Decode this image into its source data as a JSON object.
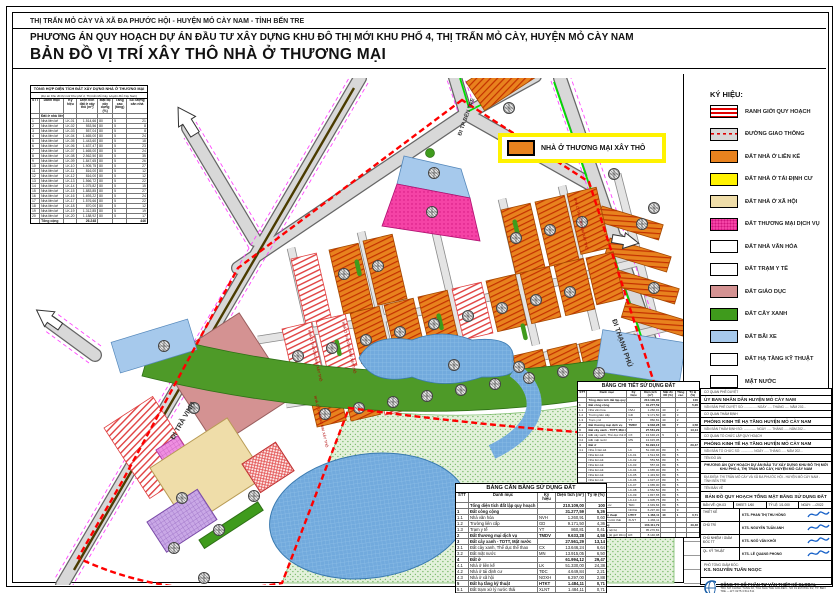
{
  "header": {
    "line1": "THỊ TRẤN MỎ CÀY VÀ XÃ ĐA PHƯỚC HỘI - HUYỆN MỎ CÀY NAM - TỈNH BẾN TRE",
    "line2": "PHƯƠNG ÁN QUY HOẠCH DỰ ÁN ĐẦU TƯ XÂY DỰNG KHU ĐÔ THỊ MỚI KHU PHỐ 4, THỊ TRẤN MỎ CÀY, HUYỆN MỎ CÀY NAM",
    "title": "BẢN ĐỒ VỊ TRÍ XÂY THÔ NHÀ Ở THƯƠNG MẠI"
  },
  "note": {
    "label": "NHÀ Ở THƯƠNG MẠI XÂY THÔ"
  },
  "legend": {
    "title": "KÝ HIỆU:",
    "items": [
      {
        "key": "boundary",
        "label": "RANH GIỚI QUY HOẠCH"
      },
      {
        "key": "road",
        "label": "ĐƯỜNG GIAO THÔNG"
      },
      {
        "key": "lienke",
        "label": "ĐẤT NHÀ Ở LIÊN KẾ"
      },
      {
        "key": "tdc",
        "label": "ĐẤT NHÀ Ở TÁI ĐỊNH CƯ"
      },
      {
        "key": "xahoi",
        "label": "ĐẤT NHÀ Ở XÃ HỘI"
      },
      {
        "key": "tmdv",
        "label": "ĐẤT THƯƠNG MẠI DỊCH VỤ"
      },
      {
        "key": "vanhoa",
        "label": "ĐẤT NHÀ VĂN HÓA"
      },
      {
        "key": "tramyte",
        "label": "ĐẤT TRẠM Y TẾ"
      },
      {
        "key": "giaoduc",
        "label": "ĐẤT GIÁO DỤC"
      },
      {
        "key": "cayxanh",
        "label": "ĐẤT CÂY XANH"
      },
      {
        "key": "baixe",
        "label": "ĐẤT BÃI XE"
      },
      {
        "key": "htkt",
        "label": "ĐẤT HẠ TẦNG KỸ THUẬT"
      },
      {
        "key": "matnuoc",
        "label": "MẶT NƯỚC"
      }
    ]
  },
  "map": {
    "road_labels": {
      "tra_vinh": "ĐI TRÀ VINH",
      "thanh_phu": "ĐI THẠNH PHÚ",
      "ben_tre": "ĐI TP BẾN TRE"
    },
    "block_label": "NHÀ Ở THƯƠNG MẠI XÂY THÔ"
  },
  "summary_table": {
    "title": "TỔNG HỢP DIỆN TÍCH ĐẤT XÂY DỰNG NHÀ Ở THƯƠNG MẠI",
    "subtitle": "(Dự án Khu đô thị mới Khu phố 4, Thị trấn Mỏ Cày, Huyện Mỏ Cày Nam)",
    "header": [
      "STT",
      "Danh mục",
      "Ký hiệu",
      "Diện tích đất ở xây thô (m²)",
      "Mật độ xây dựng (%)",
      "Tầng cao (tầng)",
      "Số lượng căn nhà"
    ],
    "section": "Đất ở nhà liên kế",
    "rows": [
      [
        "1",
        "Nhà liên kế",
        "LK-01",
        "1.514,66",
        "80",
        "5",
        "21"
      ],
      [
        "2",
        "Nhà liên kế",
        "LK-02",
        "553,56",
        "80",
        "5",
        "8"
      ],
      [
        "3",
        "Nhà liên kế",
        "LK-03",
        "557,04",
        "80",
        "5",
        "8"
      ],
      [
        "4",
        "Nhà liên kế",
        "LK-04",
        "1.665,00",
        "80",
        "5",
        "24"
      ],
      [
        "5",
        "Nhà liên kế",
        "LK-05",
        "1.443,60",
        "80",
        "5",
        "18"
      ],
      [
        "6",
        "Nhà liên kế",
        "LK-06",
        "1.637,47",
        "80",
        "5",
        "23"
      ],
      [
        "7",
        "Nhà liên kế",
        "LK-07",
        "1.665,00",
        "80",
        "5",
        "24"
      ],
      [
        "8",
        "Nhà liên kế",
        "LK-08",
        "2.562,50",
        "80",
        "5",
        "35"
      ],
      [
        "9",
        "Nhà liên kế",
        "LK-09",
        "1.847,65",
        "80",
        "5",
        "26"
      ],
      [
        "10",
        "Nhà liên kế",
        "LK-10",
        "1.905,75",
        "80",
        "5",
        "27"
      ],
      [
        "11",
        "Nhà liên kế",
        "LK-11",
        "816,00",
        "80",
        "5",
        "12"
      ],
      [
        "12",
        "Nhà liên kế",
        "LK-12",
        "816,00",
        "80",
        "5",
        "12"
      ],
      [
        "13",
        "Nhà liên kế",
        "LK-13",
        "1.566,72",
        "80",
        "5",
        "22"
      ],
      [
        "14",
        "Nhà liên kế",
        "LK-14",
        "1.075,82",
        "80",
        "5",
        "15"
      ],
      [
        "15",
        "Nhà liên kế",
        "LK-15",
        "1.883,85",
        "80",
        "5",
        "27"
      ],
      [
        "16",
        "Nhà liên kế",
        "LK-16",
        "1.693,22",
        "80",
        "5",
        "24"
      ],
      [
        "17",
        "Nhà liên kế",
        "LK-17",
        "1.576,66",
        "80",
        "5",
        "22"
      ],
      [
        "18",
        "Nhà liên kế",
        "LK-18",
        "870,00",
        "80",
        "5",
        "12"
      ],
      [
        "19",
        "Nhà liên kế",
        "LK-19",
        "1.312,85",
        "80",
        "5",
        "19"
      ],
      [
        "20",
        "Nhà liên kế",
        "LK-20",
        "1.188,92",
        "80",
        "5",
        "17"
      ]
    ],
    "total": [
      "",
      "Tổng cộng",
      "",
      "26.248",
      "",
      "",
      "446"
    ]
  },
  "balance_table": {
    "title": "BẢNG CÂN BẰNG SỬ DỤNG ĐẤT",
    "header": [
      "STT",
      "Danh mục",
      "Ký hiệu",
      "Diện tích (m²)",
      "Tỷ lệ (%)"
    ],
    "rows": [
      {
        "b": 1,
        "c": [
          "",
          "Tổng diện tích đất lập quy hoạch",
          "",
          "210.109,00",
          "100"
        ]
      },
      {
        "b": 1,
        "c": [
          "1",
          "Đất công cộng",
          "",
          "31.277,59",
          "5,26"
        ]
      },
      {
        "c": [
          "1.1",
          "Nhà văn hóa",
          "NVH",
          "1.260,91",
          "0,60"
        ]
      },
      {
        "c": [
          "1.2",
          "Trường liên cấp",
          "GD",
          "9.171,50",
          "4,36"
        ]
      },
      {
        "c": [
          "1.3",
          "Trạm y tế",
          "YT",
          "860,81",
          "0,41"
        ]
      },
      {
        "b": 1,
        "c": [
          "2",
          "Đất thương mại dịch vụ",
          "TMDV",
          "9.633,28",
          "4,58"
        ]
      },
      {
        "b": 1,
        "c": [
          "3",
          "Đất cây xanh - TDTT, Mặt nước",
          "",
          "27.561,29",
          "13,14"
        ]
      },
      {
        "c": [
          "3.1",
          "Đất cây xanh, Thể dục thể thao",
          "CX",
          "13.646,24",
          "6,64"
        ]
      },
      {
        "c": [
          "3.2",
          "Đất mặt nước",
          "MN",
          "13.915,05",
          "6,50"
        ]
      },
      {
        "b": 1,
        "c": [
          "4",
          "Đất ở",
          "",
          "61.994,12",
          "29,47"
        ]
      },
      {
        "c": [
          "4.1",
          "Nhà ở liên kế",
          "LK",
          "51.330,00",
          "24,38"
        ]
      },
      {
        "c": [
          "4.2",
          "Nhà ở tái định cư",
          "TĐC",
          "4.649,84",
          "2,21"
        ]
      },
      {
        "c": [
          "4.3",
          "Nhà ở xã hội",
          "NOXH",
          "6.297,00",
          "2,88"
        ]
      },
      {
        "b": 1,
        "c": [
          "5",
          "Đất hạ tầng kỹ thuật",
          "HTKT",
          "1.484,11",
          "0,71"
        ]
      },
      {
        "c": [
          "5.1",
          "Đất trạm xử lý nước thải",
          "XLNT",
          "1.484,11",
          "0,71"
        ]
      },
      {
        "b": 1,
        "c": [
          "6",
          "Đất giao thông",
          "",
          "103.411,79",
          "49,48"
        ]
      },
      {
        "c": [
          "6.1",
          "Đất giao thông nội bộ",
          "",
          "95.270,81",
          "45,34"
        ]
      },
      {
        "c": [
          "6.2",
          "Đất giao thông (lộ giới 30m)",
          "ĐX",
          "8.140,98",
          "4,14"
        ]
      }
    ]
  },
  "detail_table": {
    "title": "BẢNG CHI TIẾT SỬ DỤNG ĐẤT",
    "header": [
      "STT",
      "Danh mục",
      "Ký hiệu",
      "Diện tích (m²)",
      "Mật độ XD (%)",
      "Tầng cao",
      "Tỷ lệ (%)"
    ],
    "rows": [
      {
        "b": 1,
        "c": [
          "",
          "Tổng diện tích đất lập quy hoạch",
          "",
          "210.109,00",
          "",
          "",
          "100"
        ]
      },
      {
        "b": 1,
        "c": [
          "1",
          "Đất công cộng",
          "",
          "31.277,59",
          "",
          "",
          "5,26"
        ]
      },
      {
        "c": [
          "1.1",
          "Nhà văn hóa",
          "NVH",
          "1.260,91",
          "40",
          "2",
          ""
        ]
      },
      {
        "c": [
          "1.2",
          "Trường liên cấp",
          "GD",
          "9.171,50",
          "40",
          "3",
          ""
        ]
      },
      {
        "c": [
          "1.3",
          "Trạm y tế",
          "YT",
          "860,81",
          "40",
          "2",
          ""
        ]
      },
      {
        "b": 1,
        "c": [
          "2",
          "Đất thương mại dịch vụ",
          "TMDV",
          "9.633,28",
          "60",
          "7",
          "4,58"
        ]
      },
      {
        "b": 1,
        "c": [
          "3",
          "Đất cây xanh - TDTT, Mặt nước",
          "",
          "27.561,29",
          "",
          "",
          "13,14"
        ]
      },
      {
        "c": [
          "3.1",
          "Đất cây xanh, Thể dục thể thao",
          "CX",
          "13.646,24",
          "5",
          "1",
          ""
        ]
      },
      {
        "c": [
          "3.2",
          "Đất mặt nước",
          "MN",
          "13.915,05",
          "",
          "",
          ""
        ]
      },
      {
        "b": 1,
        "c": [
          "4",
          "Đất ở",
          "",
          "61.994,12",
          "",
          "",
          "29,47"
        ]
      },
      {
        "c": [
          "4.1",
          "Nhà ở liên kế",
          "LK",
          "51.330,00",
          "80",
          "5",
          ""
        ]
      },
      {
        "c": [
          "",
          "Nhà liên kế",
          "LK-01",
          "1.514,66",
          "80",
          "5",
          ""
        ]
      },
      {
        "c": [
          "",
          "Nhà liên kế",
          "LK-02",
          "553,56",
          "80",
          "5",
          ""
        ]
      },
      {
        "c": [
          "",
          "Nhà liên kế",
          "LK-03",
          "557,04",
          "80",
          "5",
          ""
        ]
      },
      {
        "c": [
          "",
          "Nhà liên kế",
          "LK-04",
          "1.665,00",
          "80",
          "5",
          ""
        ]
      },
      {
        "c": [
          "",
          "Nhà liên kế",
          "LK-05",
          "1.443,60",
          "80",
          "5",
          ""
        ]
      },
      {
        "c": [
          "",
          "Nhà liên kế",
          "LK-06",
          "1.637,47",
          "80",
          "5",
          ""
        ]
      },
      {
        "c": [
          "",
          "Nhà liên kế",
          "LK-07",
          "1.665,00",
          "80",
          "5",
          ""
        ]
      },
      {
        "c": [
          "",
          "Nhà liên kế",
          "LK-08",
          "2.562,50",
          "80",
          "5",
          ""
        ]
      },
      {
        "c": [
          "",
          "Nhà liên kế",
          "LK-09",
          "1.847,65",
          "80",
          "5",
          ""
        ]
      },
      {
        "c": [
          "",
          "Nhà liên kế",
          "LK-10",
          "1.905,75",
          "80",
          "5",
          ""
        ]
      },
      {
        "c": [
          "4.2",
          "Nhà ở tái định cư",
          "TĐC",
          "4.649,84",
          "80",
          "5",
          ""
        ]
      },
      {
        "c": [
          "4.3",
          "Nhà ở xã hội",
          "NOXH",
          "6.297,00",
          "60",
          "9",
          ""
        ]
      },
      {
        "b": 1,
        "c": [
          "5",
          "Đất hạ tầng kỹ thuật",
          "HTKT",
          "1.484,11",
          "40",
          "1",
          "0,71"
        ]
      },
      {
        "c": [
          "5.1",
          "Đất trạm xử lý nước thải",
          "XLNT",
          "1.484,11",
          "",
          "",
          ""
        ]
      },
      {
        "b": 1,
        "c": [
          "6",
          "Đất giao thông",
          "",
          "103.411,79",
          "",
          "",
          "49,48"
        ]
      },
      {
        "c": [
          "6.1",
          "Đất giao thông nội bộ",
          "",
          "95.270,81",
          "",
          "",
          ""
        ]
      },
      {
        "c": [
          "6.2",
          "Đất giao thông (lộ giới 30m)",
          "ĐX",
          "8.140,98",
          "",
          "",
          ""
        ]
      }
    ]
  },
  "title_block": {
    "approve_label": "CƠ QUAN PHÊ DUYỆT",
    "approve_value": "ỦY BAN NHÂN DÂN HUYỆN MỎ CÀY NAM",
    "approve_doc": "VĂN BẢN PHÊ DUYỆT SỐ: .............. NGÀY ..... THÁNG ..... NĂM 202...",
    "appraise_label": "CƠ QUAN THẨM ĐỊNH",
    "appraise_value": "PHÒNG KINH TẾ HẠ TẦNG HUYỆN MỎ CÀY NAM",
    "appraise_doc": "VĂN BẢN THẨM ĐỊNH SỐ: .............. NGÀY ..... THÁNG ..... NĂM 202...",
    "org_label": "CƠ QUAN TỔ CHỨC LẬP QUY HOẠCH",
    "org_value": "PHÒNG KINH TẾ HẠ TẦNG HUYỆN MỎ CÀY NAM",
    "org_doc": "VĂN BẢN TỔ CHỨC SỐ: .............. NGÀY ..... THÁNG ..... NĂM 202...",
    "project_label": "TÊN ĐỒ ÁN",
    "project_value": "PHƯƠNG ÁN QUY HOẠCH DỰ ÁN ĐẦU TƯ XÂY DỰNG KHU ĐÔ THỊ MỚI KHU PHỐ 4, THỊ TRẤN MỎ CÀY, HUYỆN MỎ CÀY NAM",
    "project_loc": "ĐỊA ĐIỂM: THỊ TRẤN MỎ CÀY VÀ XÃ ĐA PHƯỚC HỘI - HUYỆN MỎ CÀY NAM - TỈNH BẾN TRE",
    "drawing_label": "TÊN BẢN VẼ",
    "drawing_value": "BẢN ĐỒ QUY HOẠCH TỔNG MẶT BẰNG SỬ DỤNG ĐẤT",
    "meta": {
      "ban_ve": "BẢN VẼ: QH-03",
      "sheet": "SHEET: 1/60",
      "ty_le": "TỶ LỆ: 1/1.000",
      "ngay": "NGÀY: ..../2022"
    },
    "roles": [
      {
        "role": "THIẾT KẾ",
        "name": "KTS. PHAN THỊ THU HỒNG"
      },
      {
        "role": "CHỦ TRÌ",
        "name": "KTS. NGUYỄN TUẤN ANH"
      },
      {
        "role": "CHỦ NHIỆM / GIÁM ĐỐC TT",
        "name": "KTS. NGÔ VĂN KHỞI"
      },
      {
        "role": "QL. KỸ THUẬT",
        "name": "KTS. LÊ QUANG PHONG"
      }
    ],
    "deputy_role": "PHÓ TỔNG GIÁM ĐỐC:",
    "deputy_name": "KS. NGUYỄN TUẤN NGỌC",
    "company": "CÔNG TY CỔ PHẦN TƯ VẤN THIẾT KẾ GLOBAL",
    "company_sub": "TRỤ SỞ CHÍNH: TẦNG 02, TÒA NHÀ THE GOLDEN - SỐ 01 ĐƯỜNG 3/2, TP. BẾN TRE — ĐT: 0275.3.511.511",
    "sheet_code": "QH-03"
  }
}
